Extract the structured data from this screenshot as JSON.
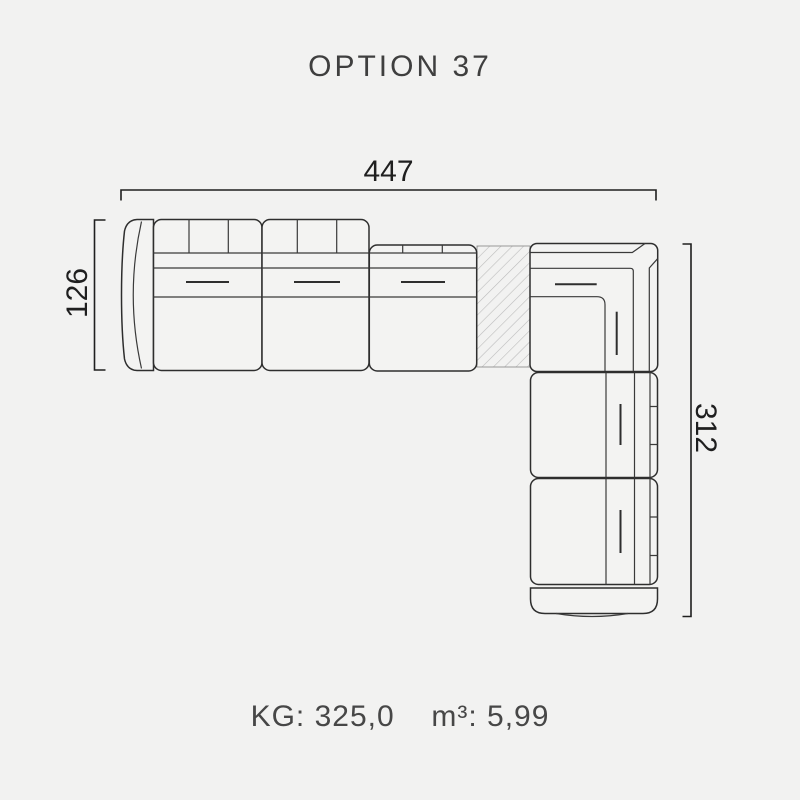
{
  "page": {
    "title": "OPTION 37"
  },
  "diagram": {
    "type": "sectional-sofa-top-view-plan",
    "dimensions": {
      "top": "447",
      "left": "126",
      "right": "312"
    }
  },
  "footer": {
    "weight_label": "KG:",
    "weight_value": "325,0",
    "volume_label": "m³:",
    "volume_value": "5,99"
  },
  "colors": {
    "background": "#f2f2f1",
    "outline": "#2e2e2e",
    "dimension_line": "#1f1f1f",
    "title_text": "#3f3f3f",
    "footer_text": "#474747",
    "hatch": "#bcbcbc"
  }
}
